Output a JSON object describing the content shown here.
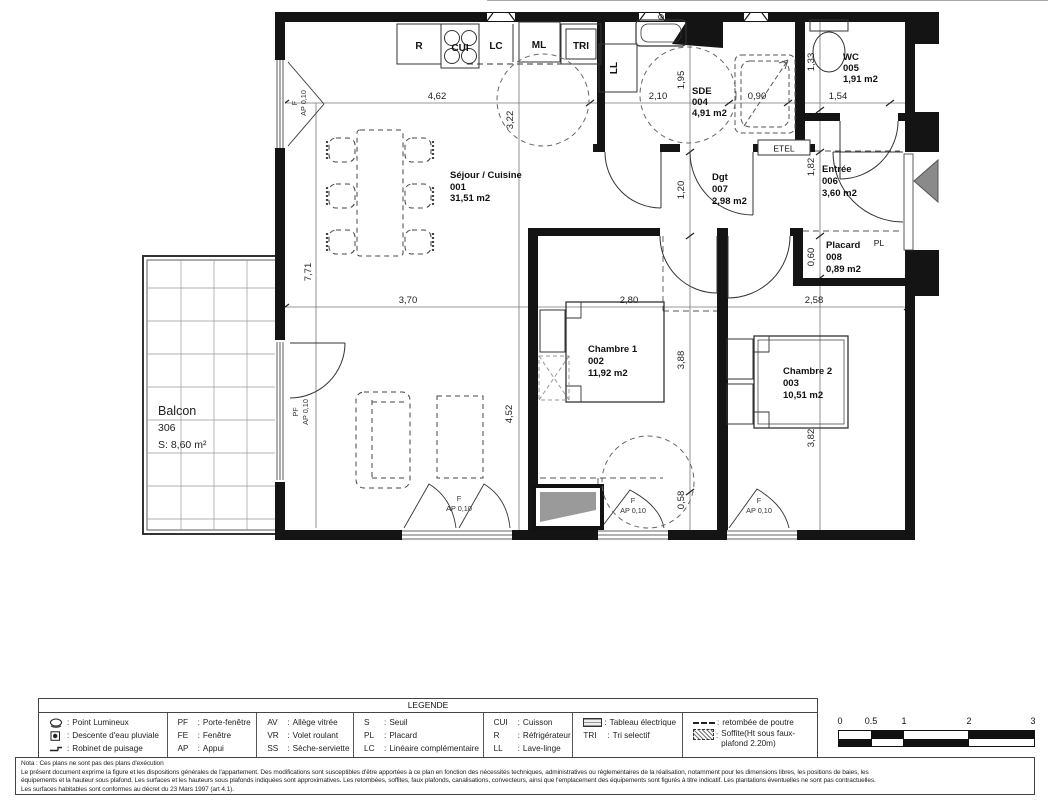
{
  "plan": {
    "rooms": {
      "sejour": {
        "name": "Séjour / Cuisine",
        "num": "001",
        "area": "31,51 m2"
      },
      "chambre1": {
        "name": "Chambre 1",
        "num": "002",
        "area": "11,92 m2"
      },
      "chambre2": {
        "name": "Chambre 2",
        "num": "003",
        "area": "10,51 m2"
      },
      "sde": {
        "name": "SDE",
        "num": "004",
        "area": "4,91 m2"
      },
      "wc": {
        "name": "WC",
        "num": "005",
        "area": "1,91 m2"
      },
      "entree": {
        "name": "Entrée",
        "num": "006",
        "area": "3,60 m2"
      },
      "dgt": {
        "name": "Dgt",
        "num": "007",
        "area": "2,98 m2"
      },
      "placard": {
        "name": "Placard",
        "num": "008",
        "area": "0,89 m2"
      },
      "balcon": {
        "name": "Balcon",
        "num": "306",
        "area": "S: 8,60 m²"
      }
    },
    "fixtures": {
      "r": "R",
      "cui": "CUI",
      "lc": "LC",
      "ml": "ML",
      "tri": "TRI",
      "ll": "LL",
      "etel": "ETEL",
      "pl": "PL"
    },
    "win": {
      "f": "F",
      "pf": "PF",
      "ap": "AP 0,10"
    },
    "dims": {
      "d462": "4,62",
      "d210": "2,10",
      "d090": "0,90",
      "d154": "1,54",
      "d370": "3,70",
      "d280": "2,80",
      "d258": "2,58",
      "d771": "7,71",
      "d322": "3,22",
      "d452": "4,52",
      "d195": "1,95",
      "d120": "1,20",
      "d388": "3,88",
      "d058": "0,58",
      "d133": "1,33",
      "d182": "1,82",
      "d060": "0,60",
      "d382": "3,82"
    }
  },
  "legend": {
    "title": "LEGENDE",
    "colon": ":",
    "icons_col": [
      {
        "icon": "ceiling-light",
        "label": "Point Lumineux"
      },
      {
        "icon": "rainwater-downpipe",
        "label": "Descente d'eau pluviale"
      },
      {
        "icon": "water-tap",
        "label": "Robinet de puisage"
      }
    ],
    "abbr_cols": [
      [
        {
          "abbr": "PF",
          "label": "Porte-fenêtre"
        },
        {
          "abbr": "FE",
          "label": "Fenêtre"
        },
        {
          "abbr": "AP",
          "label": "Appui"
        }
      ],
      [
        {
          "abbr": "AV",
          "label": "Allège vitrée"
        },
        {
          "abbr": "VR",
          "label": "Volet roulant"
        },
        {
          "abbr": "SS",
          "label": "Sèche-serviette"
        }
      ],
      [
        {
          "abbr": "S",
          "label": "Seuil"
        },
        {
          "abbr": "PL",
          "label": "Placard"
        },
        {
          "abbr": "LC",
          "label": "Linéaire complémentaire"
        }
      ],
      [
        {
          "abbr": "CUI",
          "label": "Cuisson"
        },
        {
          "abbr": "R",
          "label": "Réfrigérateur"
        },
        {
          "abbr": "LL",
          "label": "Lave-linge"
        }
      ]
    ],
    "special_col": [
      {
        "icon": "electrical-panel",
        "label": "Tableau électrique"
      },
      {
        "abbr": "TRI",
        "label": "Tri selectif"
      }
    ],
    "symbols_col": [
      {
        "icon": "dashed-line",
        "label": "retombée de poutre"
      },
      {
        "icon": "hatched-area",
        "label": "Soffite(Ht sous faux-plafond 2.20m)"
      }
    ]
  },
  "notes": {
    "line1": "Nota : Ces plans ne sont pas des plans d'exécution",
    "line2": "Le présent document exprime la figure et les dispositions générales de l'appartement. Des modifications sont susceptibles d'être apportées à ce plan en fonction des nécessités techniques, administratives ou réglementaires de la réalisation, notamment pour les dimensions libres, les positions de baies, les",
    "line3": "équipements et la hauteur sous plafond. Les surfaces et les hauteurs sous plafonds indiquées sont approximatives. Les retombées, soffites, faux plafonds, canalisations, convecteurs, ainsi que l'emplacement des équipements sont figurés à titre indicatif. Les plantations éventuelles ne sont pas contractuelles.",
    "line4": "Les surfaces habitables sont conformes au décret du 23 Mars 1997 (art 4.1)."
  },
  "scale_bar": {
    "labels": [
      "0",
      "0.5",
      "1",
      "2",
      "3"
    ]
  }
}
